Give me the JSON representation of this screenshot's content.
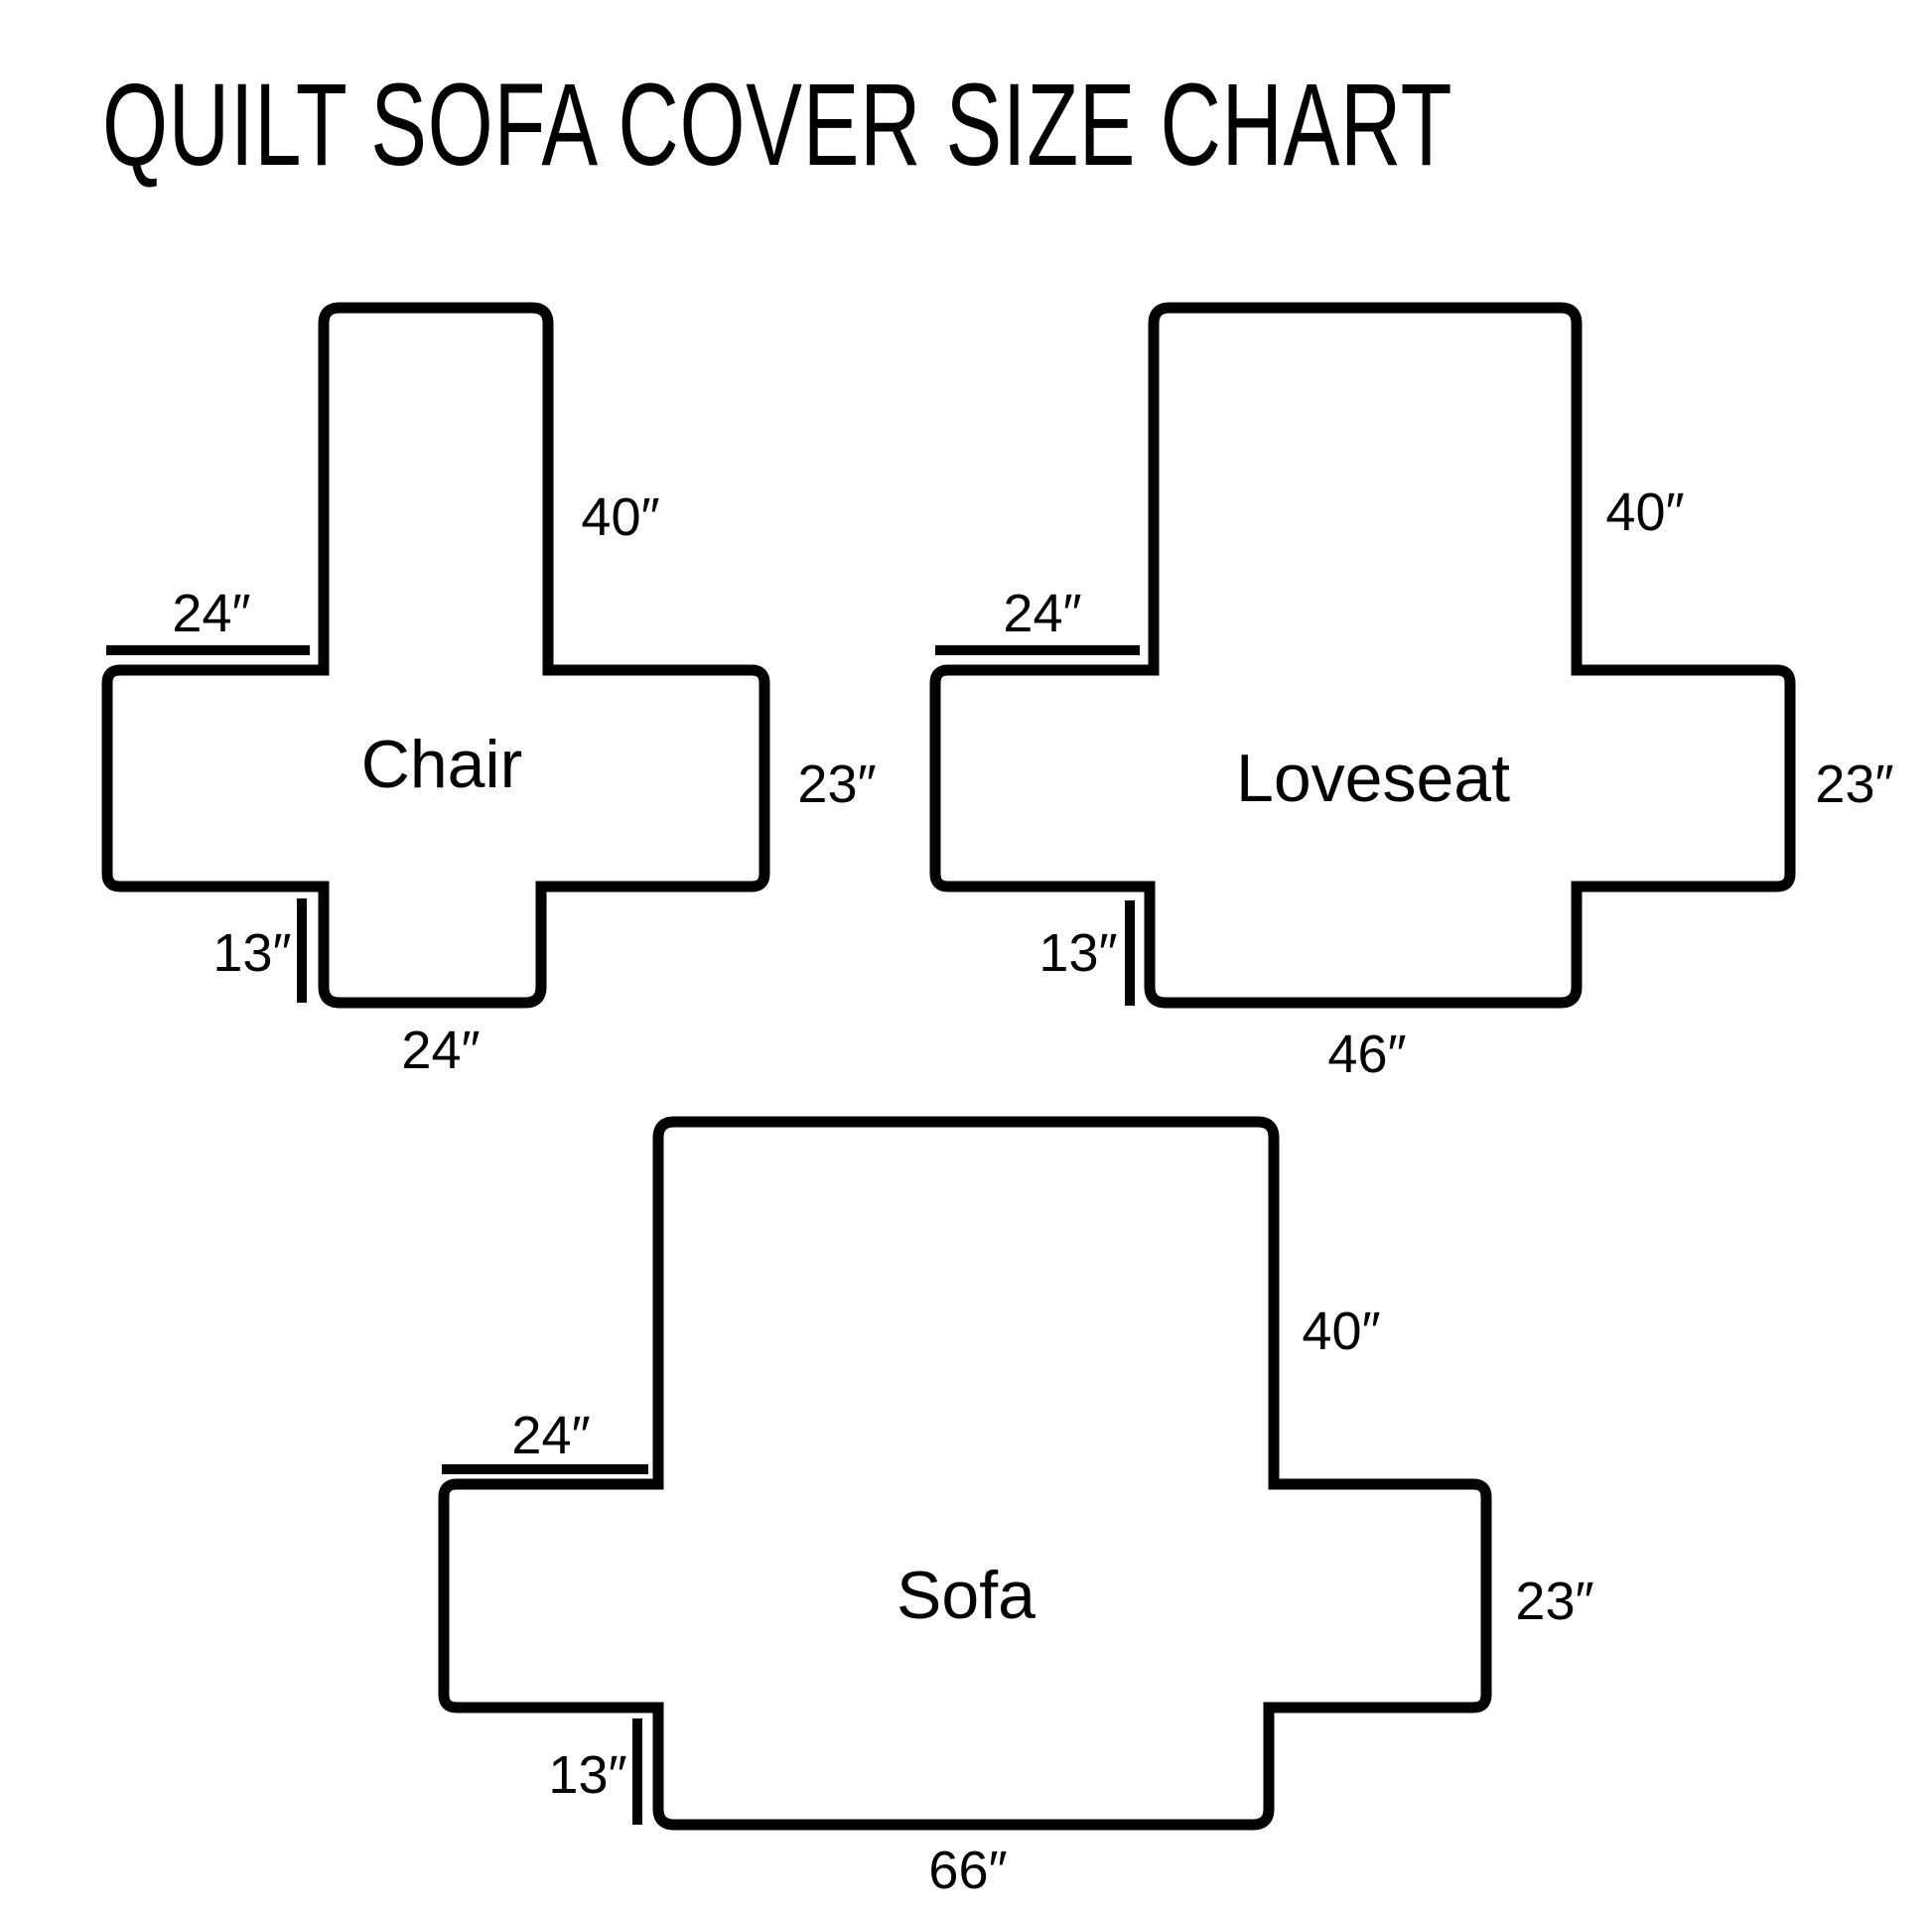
{
  "title": "QUILT SOFA COVER SIZE CHART",
  "colors": {
    "line": "#000000",
    "background": "#ffffff",
    "text": "#000000"
  },
  "diagrams": [
    {
      "name": "Chair",
      "back_height": "40″",
      "arm_depth": "24″",
      "side_height": "23″",
      "flap_height": "13″",
      "bottom_width": "24″"
    },
    {
      "name": "Loveseat",
      "back_height": "40″",
      "arm_depth": "24″",
      "side_height": "23″",
      "flap_height": "13″",
      "bottom_width": "46″"
    },
    {
      "name": "Sofa",
      "back_height": "40″",
      "arm_depth": "24″",
      "side_height": "23″",
      "flap_height": "13″",
      "bottom_width": "66″"
    }
  ]
}
